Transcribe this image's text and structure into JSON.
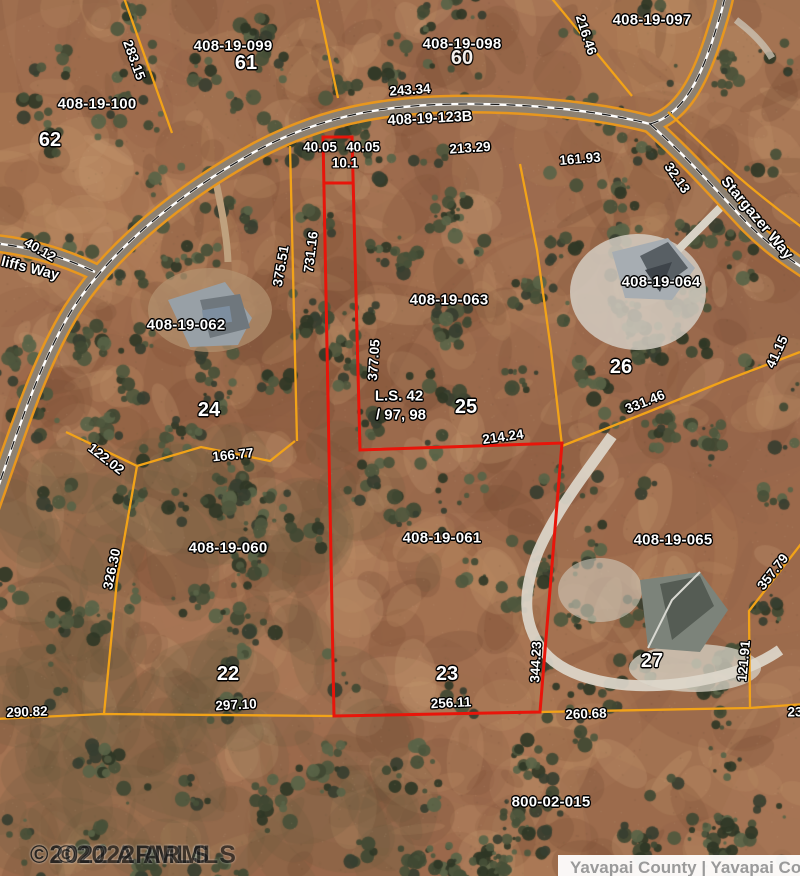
{
  "map_type": "county-parcel-aerial-map",
  "colors": {
    "parcel_line": "#f2a318",
    "subject_outline": "#e8150a",
    "road_casing": "#e8971e",
    "road_surface": "#8d8172"
  },
  "labels": {
    "apn_100": "408-19-100",
    "lot_62": "62",
    "apn_099": "408-19-099",
    "lot_61": "61",
    "apn_098": "408-19-098",
    "lot_60": "60",
    "apn_097": "408-19-097",
    "apn_062": "408-19-062",
    "lot_24": "24",
    "apn_063": "408-19-063",
    "lot_25": "25",
    "apn_064": "408-19-064",
    "lot_26": "26",
    "apn_060": "408-19-060",
    "lot_22": "22",
    "apn_061": "408-19-061",
    "lot_23": "23",
    "apn_065": "408-19-065",
    "lot_27": "27",
    "apn_800": "800-02-015"
  },
  "roads": {
    "main_label": "408-19-123B",
    "stargazer": "Stargazer Way",
    "cliffs_partial": "liffs Way"
  },
  "dimensions": {
    "d283_15": "283.15",
    "d243_34": "243.34",
    "d213_29": "213.29",
    "d161_93": "161.93",
    "d216_46": "216.46",
    "d32_13": "32.13",
    "d40_12": "40.12",
    "d40_05_a": "40.05",
    "d40_05_b": "40.05",
    "d10_1": "10.1",
    "d375_51": "375.51",
    "d731_16": "731.16",
    "d377_05": "377.05",
    "d214_24": "214.24",
    "d331_46": "331.46",
    "d41_15": "41.15",
    "d166_77": "166.77",
    "d122_02": "122.02",
    "d326_30": "326.30",
    "d344_23": "344.23",
    "d256_11": "256.11",
    "d260_68": "260.68",
    "d297_10": "297.10",
    "d290_82": "290.82",
    "d357_79": "357.79",
    "d121_91": "121.91",
    "d23_partial": "23"
  },
  "survey_note": {
    "line1": "L.S. 42",
    "line2": "/ 97, 98"
  },
  "watermarks": {
    "armls_left": "©2022 ARMLS",
    "armls_ghost": "©2022 ARMLS",
    "county_bar": "Yavapai County | Yavapai Count"
  }
}
